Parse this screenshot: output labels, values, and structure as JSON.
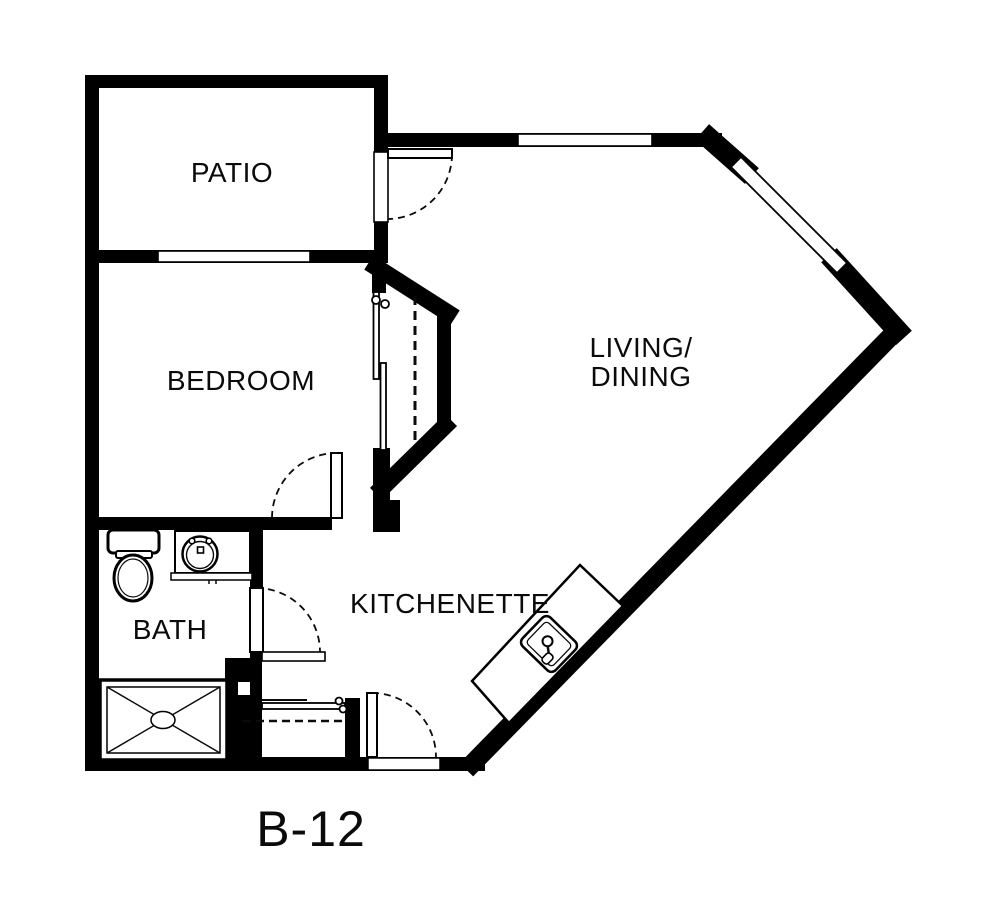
{
  "plan": {
    "unit_label": "B-12",
    "rooms": {
      "patio": "PATIO",
      "bedroom": "BEDROOM",
      "living_line1": "LIVING/",
      "living_line2": "DINING",
      "kitchenette": "KITCHENETTE",
      "bath": "BATH"
    },
    "fixtures": [
      "toilet",
      "bathroom-sink-vanity",
      "shower",
      "entry-closet-rod",
      "bedroom-closet-sliding-doors",
      "kitchen-island-counter",
      "kitchen-sink"
    ],
    "doors": [
      "patio-door",
      "bedroom-door",
      "bath-door",
      "entry-door"
    ],
    "windows": [
      "patio-bedroom-window",
      "living-top-window",
      "living-diagonal-window"
    ],
    "colors": {
      "wall": "#000000",
      "background": "#ffffff",
      "line": "#0b0b0b"
    }
  }
}
